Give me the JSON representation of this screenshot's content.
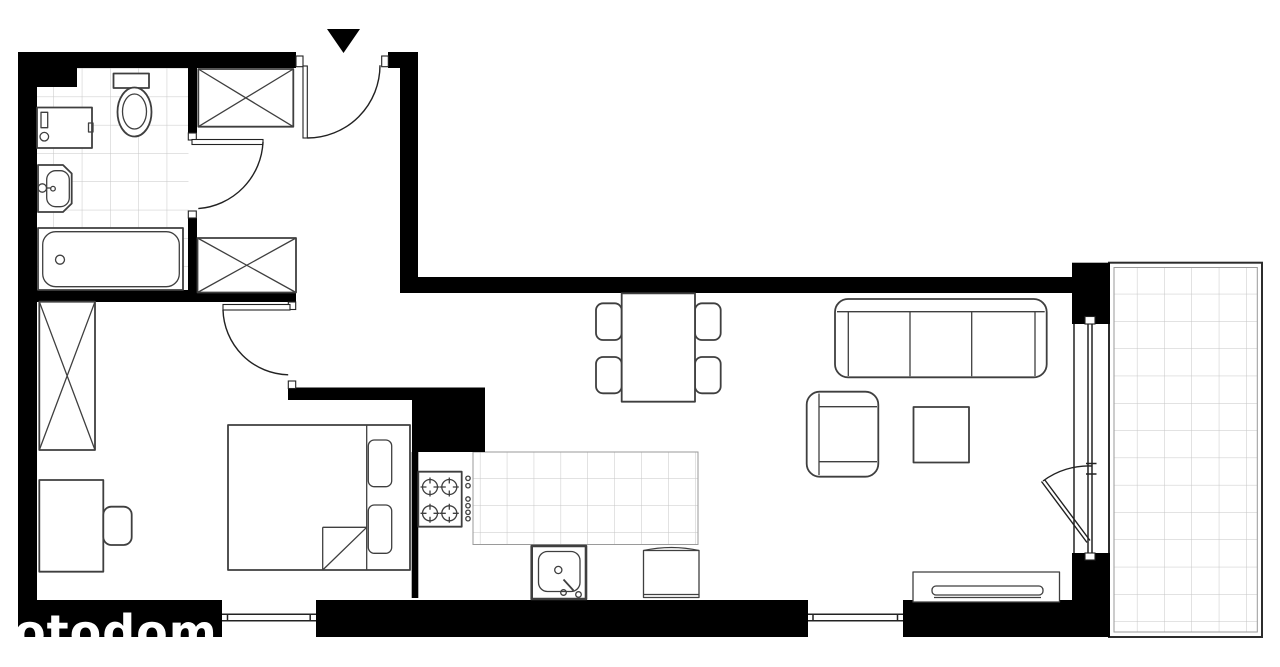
{
  "watermark": {
    "text": "otodom"
  },
  "palette": {
    "wall": "#000000",
    "line": "#3f3f3f",
    "door": "#222222",
    "tile": "#c6c6c6",
    "bg": "#ffffff"
  },
  "plan": {
    "type": "apartment-floor-plan",
    "entrance_marker": "filled-triangle-pointing-down",
    "rooms": [
      "bathroom",
      "hall",
      "bedroom",
      "kitchen",
      "living-dining-room",
      "balcony"
    ],
    "doors": [
      "entrance-door",
      "bathroom-door",
      "bedroom-door",
      "balcony-door"
    ],
    "windows": [
      "bedroom-window",
      "living-room-window",
      "balcony-glazed-wall"
    ],
    "fixtures": {
      "bathroom": [
        "toilet",
        "washing-machine",
        "washbasin",
        "bathtub",
        "tiled-floor"
      ],
      "hall": [
        "wardrobe-top",
        "wardrobe-bottom"
      ],
      "bedroom": [
        "wardrobe",
        "desk",
        "desk-chair",
        "double-bed-with-pillows"
      ],
      "kitchen": [
        "stove-four-burners",
        "tiled-counter",
        "kitchen-sink",
        "fridge-cabinet"
      ],
      "living_room": [
        "dining-table",
        "dining-chairs-x4",
        "sofa-three-seat",
        "armchair",
        "coffee-table",
        "tv-sideboard"
      ],
      "balcony": [
        "tiled-floor"
      ]
    }
  }
}
